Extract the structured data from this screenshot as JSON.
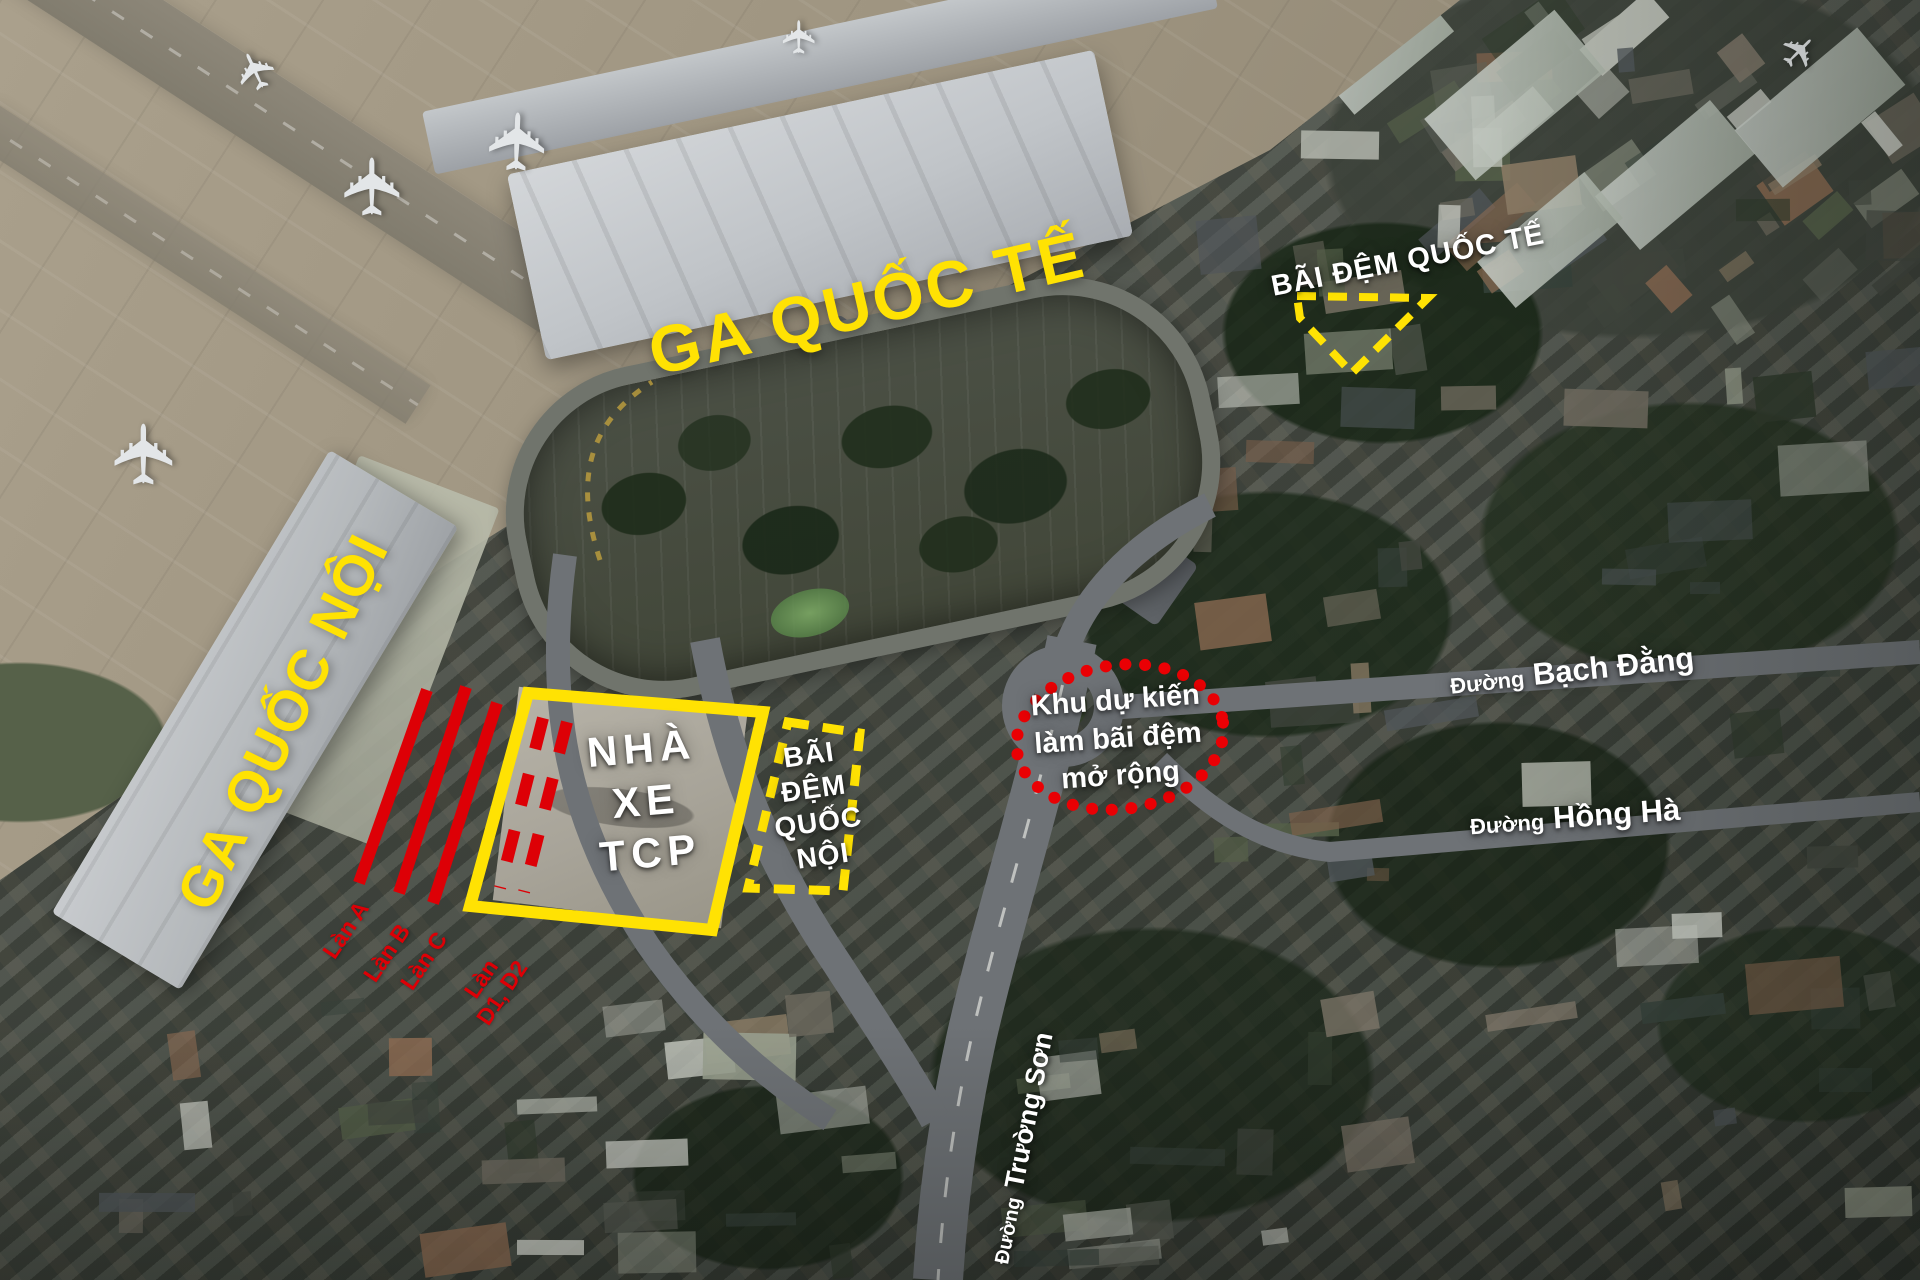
{
  "annotations": {
    "international_terminal": {
      "text": "GA QUỐC TẾ"
    },
    "domestic_terminal": {
      "text": "GA QUỐC NỘI"
    },
    "international_buffer": {
      "text": "BÃI ĐỆM QUỐC TẾ"
    },
    "tcp_parking": {
      "line1": "NHÀ",
      "line2": "XE",
      "line3": "TCP"
    },
    "domestic_buffer": {
      "line1": "BÃI",
      "line2": "ĐỆM",
      "line3": "QUỐC",
      "line4": "NỘI"
    },
    "expansion_area": {
      "line1": "Khu dự kiến",
      "line2": "làm bãi đệm",
      "line3": "mở rộng"
    },
    "lanes": {
      "a": "Làn A",
      "b": "Làn B",
      "c": "Làn C",
      "d_line1": "Làn",
      "d_line2": "D1, D2"
    },
    "streets": {
      "bach_dang": {
        "prefix": "Đường",
        "name": "Bạch Đằng"
      },
      "hong_ha": {
        "prefix": "Đường",
        "name": "Hồng Hà"
      },
      "truong_son": {
        "prefix": "Đường",
        "name": "Trường Sơn"
      }
    }
  },
  "legend_colors": {
    "highlight_yellow": "#ffe203",
    "highlight_red": "#dd0006",
    "label_white": "#ffffff"
  }
}
